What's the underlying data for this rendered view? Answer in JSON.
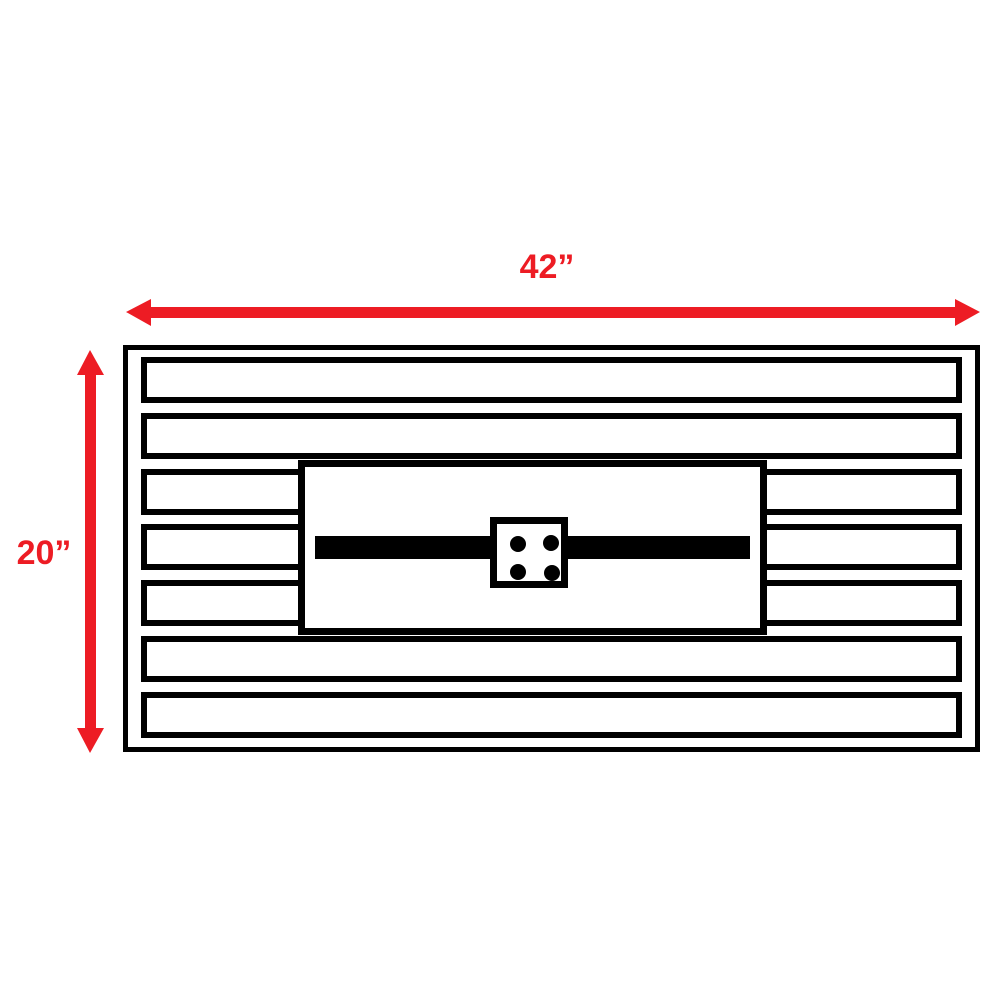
{
  "colors": {
    "dimension-red": "#ed1c24",
    "outline-black": "#000000",
    "background": "#ffffff"
  },
  "dimensions": {
    "width": {
      "label": "42”"
    },
    "height": {
      "label": "20”"
    }
  },
  "structure": {
    "slat_count": 7,
    "burner_hole_count": 4
  }
}
